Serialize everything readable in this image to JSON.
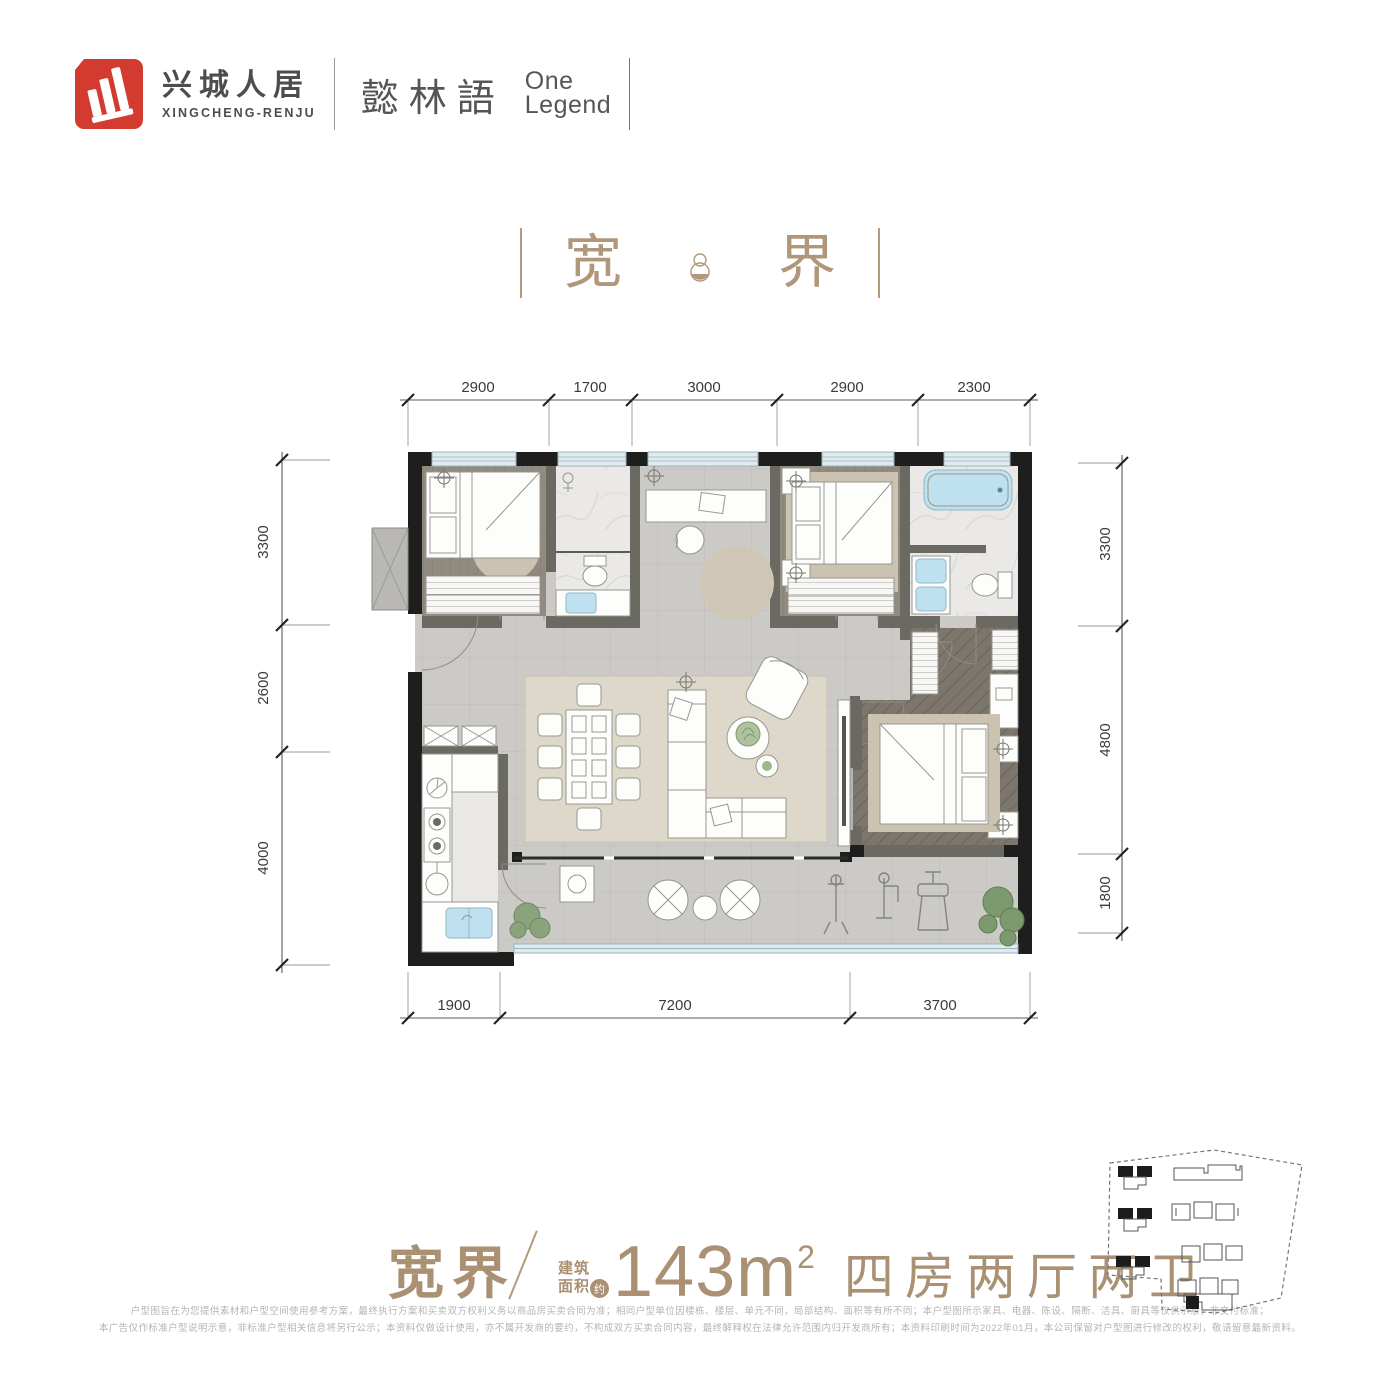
{
  "brand": {
    "name_cn": "兴城人居",
    "name_en": "XINGCHENG-RENJU",
    "project_cn": "懿林語",
    "project_en_line1": "One",
    "project_en_line2": "Legend"
  },
  "hero": {
    "char_left": "宽",
    "char_right": "界"
  },
  "plan": {
    "dims": {
      "top": [
        "2900",
        "1700",
        "3000",
        "2900",
        "2300"
      ],
      "left": [
        "3300",
        "2600",
        "4000"
      ],
      "right": [
        "3300",
        "4800",
        "1800"
      ],
      "bottom": [
        "1900",
        "7200",
        "3700"
      ]
    }
  },
  "footer": {
    "plan_name": "宽界",
    "area_label_top": "建筑",
    "area_label_bottom": "面积",
    "area_approx": "约",
    "area_value": "143m",
    "area_exponent": "2",
    "layout": "四房两厅两卫",
    "disclaimer_line1": "户型图旨在为您提供素材和户型空间使用参考方案，最终执行方案和买卖双方权利义务以商品房买卖合同为准；相同户型单位因楼栋、楼层、单元不同，局部结构、面积等有所不同；本户型图所示家具、电器、陈设、隔断、洁具、厨具等仅供示意，非交付标准；",
    "disclaimer_line2": "本广告仅作标准户型说明示意，非标准户型相关信息将另行公示；本资料仅做设计使用，亦不属开发商的要约，不构成双方买卖合同内容，最终解释权在法律允许范围内归开发商所有；本资料印刷时间为2022年01月，本公司保留对户型图进行修改的权利，敬请留意最新资料。"
  },
  "colors": {
    "accent_tan": "#b1977a",
    "logo_red": "#d43b30",
    "wall_black": "#1e1e1e",
    "dim_text": "#3a3a3a",
    "water_blue": "#bfe0ee"
  }
}
